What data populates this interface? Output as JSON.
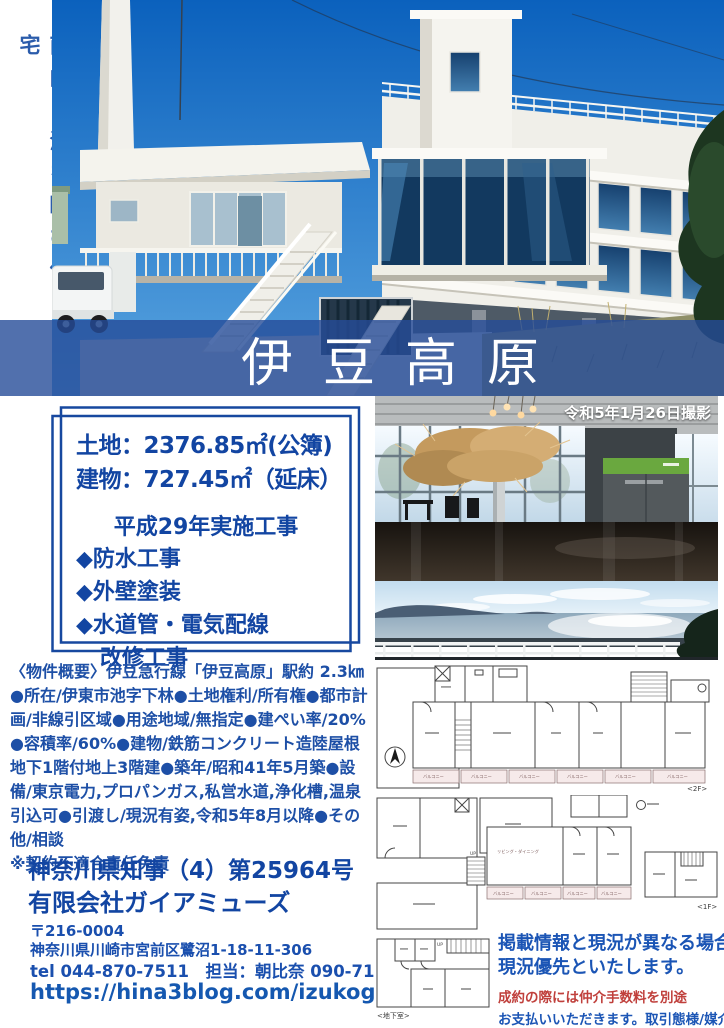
{
  "hero": {
    "vertical_tagline": "南向き海を臨む住宅",
    "banner_title": "伊豆高原",
    "photo_date_caption": "令和5年1月26日撮影"
  },
  "info_box": {
    "land_line": "土地：2376.85㎡(公簿)",
    "building_line": "建物：727.45㎡（延床）",
    "works_title": "平成29年実施工事",
    "works": [
      "◆防水工事",
      "◆外壁塗装",
      "◆水道管・電気配線",
      "改修工事"
    ]
  },
  "overview": {
    "text": "〈物件概要〉伊豆急行線「伊豆高原」駅約 2.3㎞●所在/伊東市池字下林●土地権利/所有権●都市計画/非線引区域●用途地域/無指定●建ぺい率/20%●容積率/60%●建物/鉄筋コンクリート造陸屋根地下1階付地上3階建●築年/昭和41年5月築●設備/東京電力,プロパンガス,私営水道,浄化槽,温泉引込可●引渡し/現況有姿,令和5年8月以降●その他/相談",
    "note": "※契約不適合責任免責"
  },
  "agency": {
    "license": "神奈川県知事（4）第25964号",
    "name": "有限会社ガイアミューズ",
    "postal": "〒216-0004",
    "address": "神奈川県川崎市宮前区鷺沼1-18-11-306",
    "tel_line": "tel 044-870-7511　担当：朝比奈 090-7179-8070",
    "url": "https://hina3blog.com/izukogen/"
  },
  "disclaimer": {
    "line1": "掲載情報と現況が異なる場合は",
    "line2": "現況優先といたします。",
    "line3": "成約の際には仲介手数料を別途",
    "line4": "お支払いいただきます。取引態様/媒介"
  },
  "floorplan": {
    "floor2_label": "<2F>",
    "floor1_label": "<1F>",
    "basement_label": "<地下室>",
    "balcony_label": "バルコニー",
    "living_label": "リビング・ダイニング",
    "up_label": "UP"
  },
  "colors": {
    "primary_blue": "#1245a2",
    "banner_overlay": "#264c98",
    "accent_red": "#c0403c"
  }
}
